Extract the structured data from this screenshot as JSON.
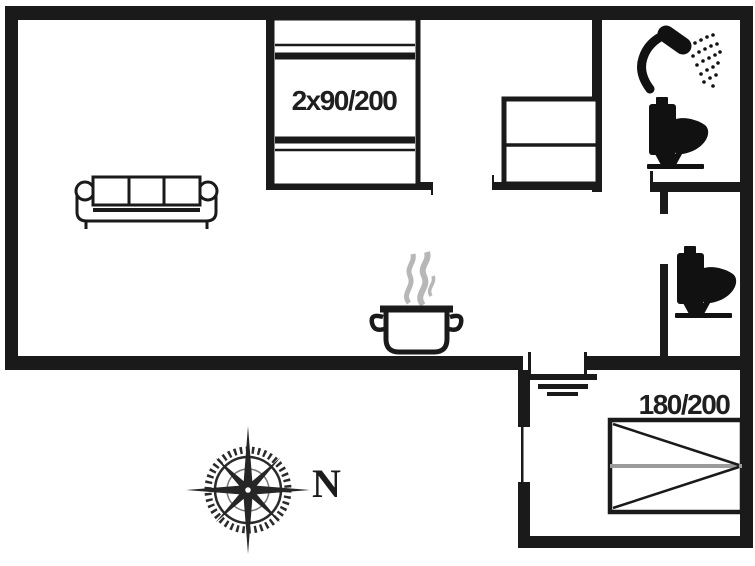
{
  "canvas": {
    "width": 755,
    "height": 566,
    "background": "#ffffff",
    "wall_color": "#1a1a1a",
    "steam_color": "#b7b7b7",
    "duvet_fold_line_color": "#9b9b9b"
  },
  "floorplan": {
    "labels": {
      "small_bedroom_bed": "2x90/200",
      "annex_bed": "180/200",
      "compass_north": "N"
    },
    "icons": [
      "sofa-icon",
      "double-bed-icon",
      "wardrobe-icon",
      "shower-icon",
      "toilet-icon",
      "toilet-icon",
      "cooking-pot-icon",
      "steam-icon",
      "water-symbol-icon",
      "double-bed-icon",
      "compass-rose-icon"
    ]
  }
}
